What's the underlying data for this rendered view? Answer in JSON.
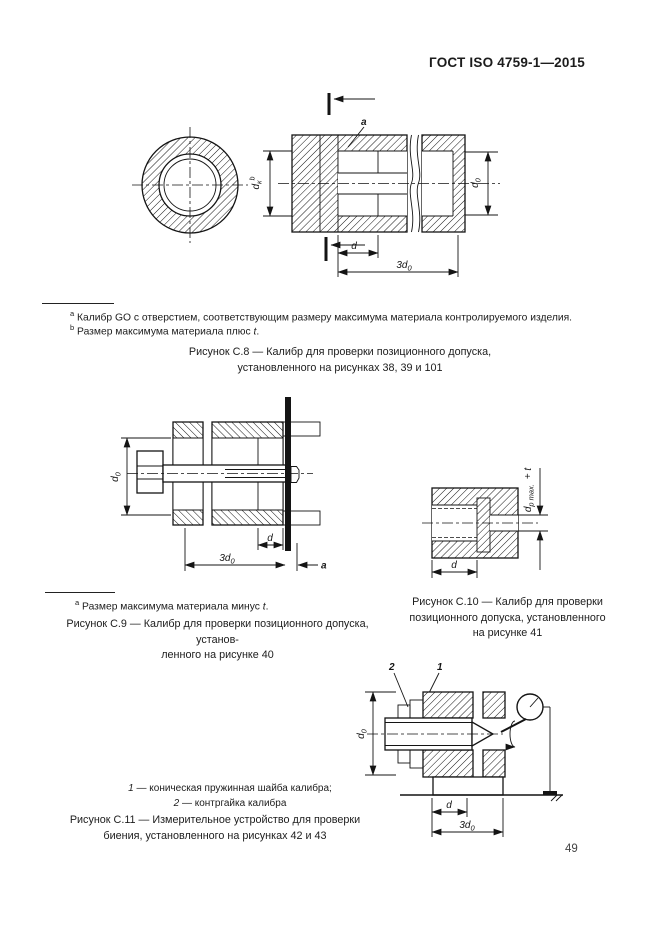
{
  "page": {
    "header": "ГОСТ ISO 4759-1—2015",
    "number": "49"
  },
  "figure_c8": {
    "footnotes": {
      "a_marker": "a",
      "a_text": "Калибр GO с отверстием, соответствующим размеру максимума материала контролируемого изделия.",
      "b_marker": "b",
      "b_text": "Размер максимума материала плюс ",
      "b_var": "t",
      "b_end": "."
    },
    "caption_line1": "Рисунок С.8 — Калибр для проверки позиционного допуска,",
    "caption_line2": "установленного на рисунках 38, 39 и 101",
    "labels": {
      "marker_a": "a",
      "dk_main": "d",
      "dk_sub": "к",
      "dk_sup": "b",
      "d0_main": "d",
      "d0_sub": "0",
      "d": "d",
      "d3_main": "3d",
      "d3_sub": "0"
    }
  },
  "figure_c9": {
    "footnote": {
      "marker": "a",
      "text": "Размер максимума материала минус ",
      "var": "t",
      "end": "."
    },
    "caption_line1": "Рисунок С.9 — Калибр для проверки позиционного допуска, установ-",
    "caption_line2": "ленного на рисунке 40",
    "labels": {
      "d0_main": "d",
      "d0_sub": "0",
      "d": "d",
      "d3_main": "3d",
      "d3_sub": "0",
      "marker_a": "a"
    }
  },
  "figure_c10": {
    "caption_line1": "Рисунок С.10 — Калибр для проверки",
    "caption_line2": "позиционного допуска, установленного",
    "caption_line3": "на рисунке 41",
    "labels": {
      "dp_main": "d",
      "dp_sub": "p max.",
      "dp_plus": " + t",
      "d": "d"
    }
  },
  "figure_c11": {
    "legend": {
      "item1_num": "1",
      "item1_text": " — коническая пружинная шайба калибра;",
      "item2_num": "2",
      "item2_text": " — контргайка калибра"
    },
    "caption_line1": "Рисунок С.11 — Измерительное устройство для проверки",
    "caption_line2": "биения, установленного на рисунках 42 и 43",
    "labels": {
      "item1": "1",
      "item2": "2",
      "d0_main": "d",
      "d0_sub": "0",
      "d": "d",
      "d3_main": "3d",
      "d3_sub": "0"
    }
  }
}
